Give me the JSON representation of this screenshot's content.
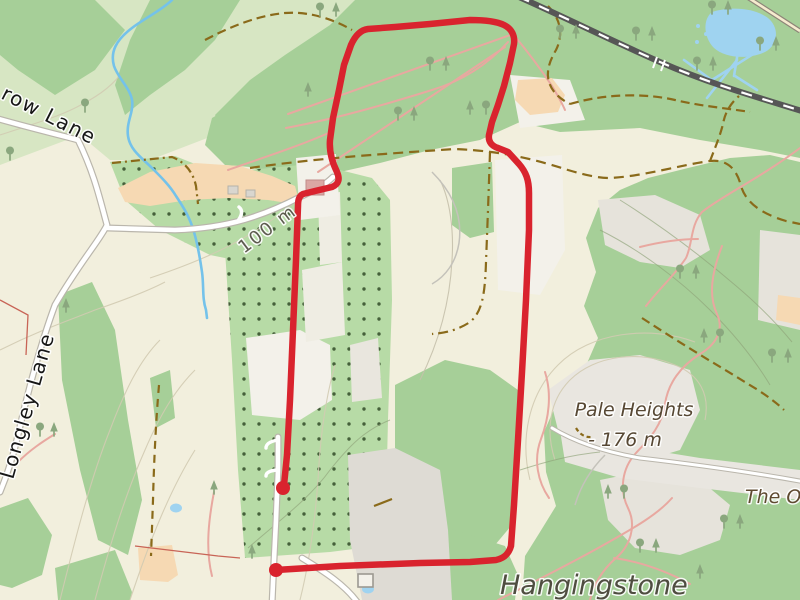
{
  "map": {
    "labels": {
      "road_top": {
        "text": "row Lane"
      },
      "road_left": {
        "text": "Longley Lane"
      },
      "contour": {
        "text": "100 m"
      },
      "peak_name": {
        "text": "Pale Heights"
      },
      "peak_elevation": {
        "text": "- 176 m"
      },
      "place_right_partial": {
        "text": "The O"
      },
      "place_bottom_partial": {
        "text": "Hangingstone"
      }
    },
    "route": {
      "color": "#d9232e",
      "stroke_width": 6.5,
      "marker_radius": 7,
      "path_d": "M 276,570 L 340,566 L 420,563 L 470,562 L 496,560 C 505,558 509,553 511,546 L 514,505 L 518,440 L 522,372 L 526,300 L 529,230 L 529,193 C 529,180 526,172 519,164 L 508,152 L 498,148 C 492,146 488,142 489,135 L 492,122 L 498,105 L 504,86 L 510,63 L 514,44 C 515,36 512,29 504,25 C 496,21 484,20 470,20 L 430,24 L 395,27 L 368,29 C 360,30 355,36 351,45 L 344,65 L 339,90 L 333,118 L 330,140 C 329,152 332,162 337,172 C 340,179 339,184 332,187 L 315,191 L 303,194 C 299,196 298,200 298,206 L 296,260 L 293,330 L 290,400 L 287,455 L 284,485",
      "markers": [
        {
          "x": 276,
          "y": 570
        },
        {
          "x": 283,
          "y": 488
        }
      ]
    },
    "tree_symbols": [
      [
        320,
        16,
        "d"
      ],
      [
        336,
        16,
        "c"
      ],
      [
        430,
        70,
        "d"
      ],
      [
        446,
        70,
        "c"
      ],
      [
        398,
        120,
        "d"
      ],
      [
        414,
        120,
        "c"
      ],
      [
        470,
        114,
        "c"
      ],
      [
        486,
        114,
        "d"
      ],
      [
        308,
        96,
        "c"
      ],
      [
        560,
        38,
        "d"
      ],
      [
        576,
        38,
        "c"
      ],
      [
        636,
        40,
        "d"
      ],
      [
        652,
        40,
        "c"
      ],
      [
        712,
        14,
        "d"
      ],
      [
        728,
        14,
        "c"
      ],
      [
        760,
        50,
        "d"
      ],
      [
        776,
        50,
        "c"
      ],
      [
        697,
        70,
        "d"
      ],
      [
        713,
        70,
        "c"
      ],
      [
        680,
        278,
        "d"
      ],
      [
        696,
        278,
        "c"
      ],
      [
        704,
        342,
        "c"
      ],
      [
        720,
        342,
        "d"
      ],
      [
        772,
        362,
        "d"
      ],
      [
        788,
        362,
        "c"
      ],
      [
        608,
        498,
        "c"
      ],
      [
        624,
        498,
        "d"
      ],
      [
        640,
        552,
        "d"
      ],
      [
        656,
        552,
        "c"
      ],
      [
        700,
        578,
        "c"
      ],
      [
        724,
        528,
        "d"
      ],
      [
        740,
        528,
        "c"
      ],
      [
        214,
        494,
        "c"
      ],
      [
        252,
        558,
        "c"
      ],
      [
        66,
        312,
        "c"
      ],
      [
        40,
        436,
        "d"
      ],
      [
        54,
        436,
        "c"
      ],
      [
        10,
        160,
        "d"
      ],
      [
        85,
        112,
        "d"
      ]
    ],
    "colors": {
      "route": "#d9232e",
      "water": "#74c2ea",
      "water_fill": "#9fd3f0",
      "forest": "#a6cf98",
      "forest_light": "#d7e6c3",
      "forest_dotted": "#b7dba6",
      "forest_dot": "#45603a",
      "farmland": "#f2efdd",
      "clearing": "#e6e3db",
      "white_patch": "#f3f1ea",
      "residential": "#f6d9b3",
      "road_fill": "#ffffff",
      "road_casing": "#bab6ac",
      "railway": "#565656",
      "track_pink": "#e8a8a0",
      "path_dashed": "#8a6a1a",
      "contour": "#d2cbb2",
      "contour_forest": "#8fa379",
      "boundary": "#c86456",
      "tree": "#8aa77e",
      "building_pink": "#dba8a4",
      "building_grey": "#dedbd4"
    }
  }
}
